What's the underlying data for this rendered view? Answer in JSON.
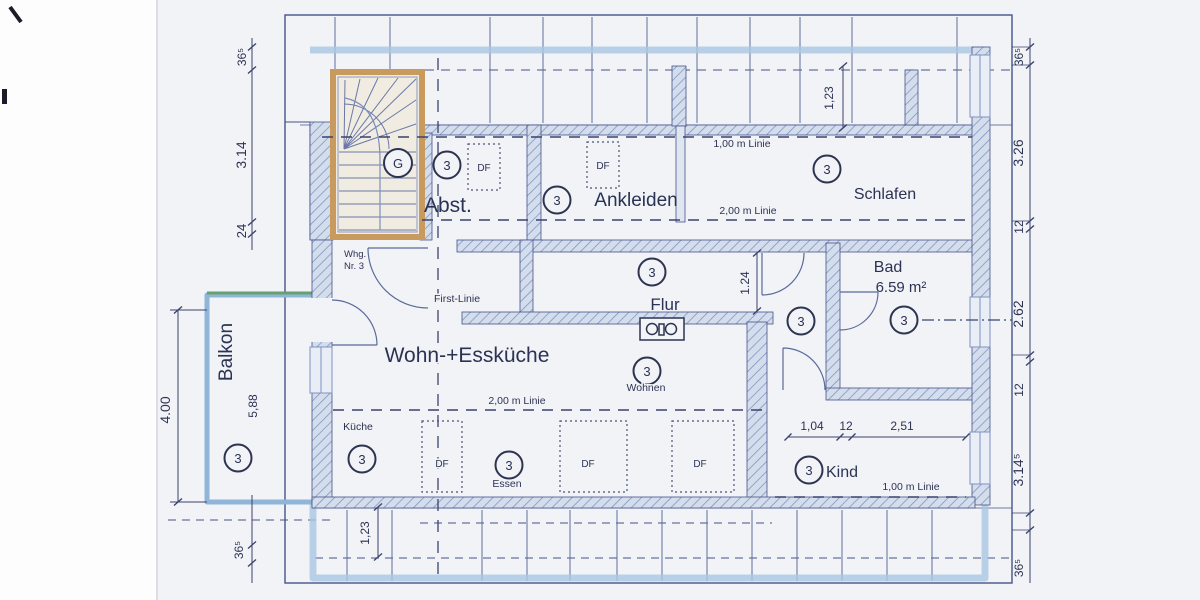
{
  "unit_marker": "3",
  "stair_marker": "G",
  "window_marker": "DF",
  "rooms": {
    "abstellraum": "Abst.",
    "ankleiden": "Ankleiden",
    "schlafen": "Schlafen",
    "bad": "Bad",
    "bad_area": "6.59 m²",
    "flur": "Flur",
    "wohn_esskueche": "Wohn-+Essküche",
    "kueche": "Küche",
    "wohnen": "Wohnen",
    "essen": "Essen",
    "kind": "Kind",
    "balkon": "Balkon"
  },
  "unit_label": {
    "line1": "Whg.",
    "line2": "Nr. 3"
  },
  "height_lines": {
    "first": "First-Linie",
    "one_m_top": "1,00 m Linie",
    "two_m_top": "2,00 m Linie",
    "two_m_bottom": "2,00 m Linie",
    "one_m_bottom": "1,00 m Linie"
  },
  "dimensions": {
    "left_top": "36⁵",
    "left_height": "3.14",
    "left_small": "24",
    "left_bottom": "36⁵",
    "balkon_depth": "4.00",
    "balkon_length": "5,88",
    "right_top": "36⁵",
    "right_schlafen": "3.26",
    "right_wall1": "12",
    "right_bad": "2.62",
    "right_wall2": "12",
    "right_kind": "3.14⁵",
    "right_bottom": "36⁵",
    "dormer_top": "1,23",
    "dormer_bottom": "1,23",
    "flur_width": "1.24",
    "kind_chain": [
      "1,04",
      "12",
      "2,51"
    ]
  },
  "colors": {
    "line_ink": "#39436e",
    "highlight_blue": "#a9c7e2",
    "stair_orange": "#c89a5e",
    "balcony_green": "#67a06f",
    "wall_fill": "#d3ddec"
  }
}
